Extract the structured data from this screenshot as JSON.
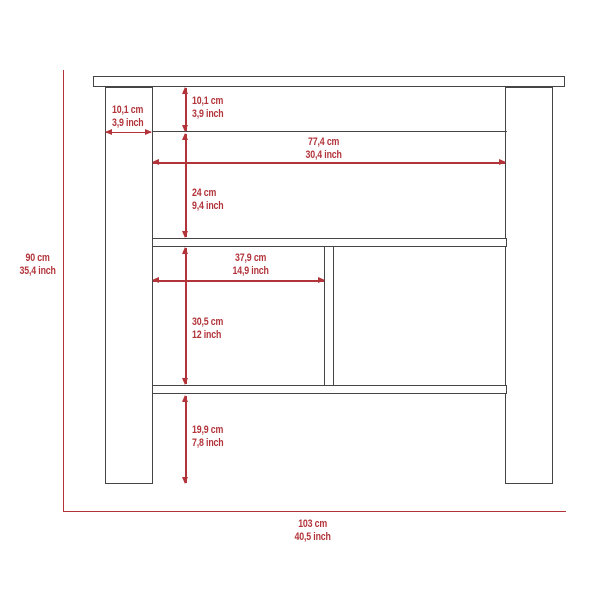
{
  "diagram": {
    "kind": "furniture-dimension-diagram",
    "colors": {
      "outline": "#454545",
      "dimension": "#b2343a",
      "background": "#ffffff"
    },
    "labels": {
      "overall_height": {
        "cm": "90 cm",
        "inch": "35,4 inch"
      },
      "overall_width": {
        "cm": "103 cm",
        "inch": "40,5 inch"
      },
      "leg_width": {
        "cm": "10,1 cm",
        "inch": "3,9 inch"
      },
      "top_rail_height": {
        "cm": "10,1 cm",
        "inch": "3,9 inch"
      },
      "inner_width": {
        "cm": "77,4 cm",
        "inch": "30,4 inch"
      },
      "upper_compartment_height": {
        "cm": "24 cm",
        "inch": "9,4 inch"
      },
      "cubby_width": {
        "cm": "37,9 cm",
        "inch": "14,9 inch"
      },
      "cubby_height": {
        "cm": "30,5 cm",
        "inch": "12 inch"
      },
      "bottom_gap_height": {
        "cm": "19,9 cm",
        "inch": "7,8 inch"
      }
    }
  }
}
